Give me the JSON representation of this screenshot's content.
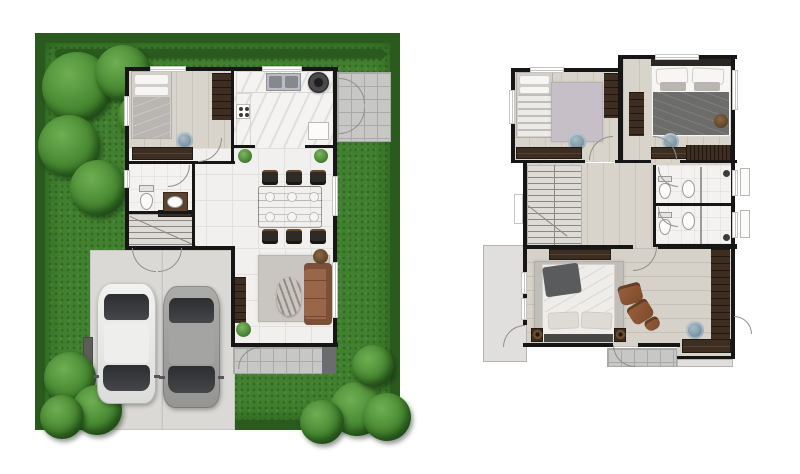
{
  "image": {
    "kind": "architectural-floor-plan-rendering",
    "panels": 2,
    "visible_text": ""
  },
  "plans": [
    {
      "id": "first-floor-site-plan",
      "site_elements": [
        "lawn",
        "hedge-border",
        "trees-shrubs",
        "concrete-driveway",
        "ac-pad"
      ],
      "rooms": [
        "bedroom",
        "bathroom",
        "stairs",
        "kitchen",
        "dining-area",
        "living-room",
        "rear-terrace",
        "front-terrace",
        "carport"
      ],
      "furniture": [
        "single-bed",
        "wardrobe",
        "dresser",
        "pouf",
        "toilet",
        "vanity-sink",
        "kitchen-counter",
        "double-sink",
        "round-cooktop",
        "cooktop",
        "refrigerator",
        "dining-table",
        "dining-chair-x6",
        "plate-x6",
        "sofa",
        "coffee-table",
        "tv-cabinet",
        "side-table",
        "potted-plant-x3",
        "white-car",
        "gray-car"
      ]
    },
    {
      "id": "second-floor-plan",
      "rooms": [
        "bedroom-2",
        "master-bedroom",
        "bedroom-3",
        "bathroom-upper",
        "bathroom-lower",
        "hallway",
        "stairs",
        "balcony-left",
        "balcony-rear",
        "walk-in-closet"
      ],
      "furniture": [
        "single-bed",
        "double-bed-x2",
        "rug-x3",
        "wardrobe-x4",
        "dresser-x4",
        "pouf-x3",
        "nightstand-x2",
        "lamp-x2",
        "armchair-x2",
        "ottoman",
        "toilet-x2",
        "pedestal-sink-x2",
        "shower-x2",
        "tv-cabinet",
        "round-side-table",
        "ac-unit-x2"
      ]
    }
  ],
  "colors": {
    "wall": "#161616",
    "grass-base": "#41802e",
    "hedge": "#2a5a1e",
    "bush-light": "#6fae52",
    "bush-mid": "#468730",
    "bush-dark": "#27541c",
    "wood-floor": "#d9d4cb",
    "wood-floor2": "#d6d1c9",
    "tile-floor": "#f1f0ee",
    "tile-line": "#e1e0dd",
    "marble": "#f4f3f1",
    "bath-floor": "#f3f2f0",
    "terrace-tile": "#c7c7c5",
    "terrace-line": "#a9a9a7",
    "terrace-dark": "#6a6c6e",
    "concrete": "#dbd9d5",
    "concrete-line": "#c8c6c2",
    "balcony": "#e0dfdd",
    "balcony-line": "#b5b4b2",
    "dark-wood": "#3e2e21",
    "mid-wood": "#5a4430",
    "chair-dark": "#2e2a26",
    "chair-wood": "#6b4a2c",
    "sofa": "#996649",
    "sofa-dark": "#7c4f38",
    "rug": "#c9c6c1",
    "rug-lilac": "#c6bfc7",
    "rug-warm": "#c1bdb8",
    "bed-frame": "#d3cfca",
    "bed-gray": "#b9b5b0",
    "duvet-dark": "#6c6c6a",
    "linen-white": "#f7f6f4",
    "linen-warm": "#efede9",
    "pouf": "#7d96a6",
    "pouf-dark": "#56707f",
    "steel": "#b9bcc0",
    "appliance-dark": "#3b3b3d",
    "plant-green": "#4e8a3a",
    "plant-dark": "#2e5c1e",
    "glass-dark": "#2c2e32",
    "fixture-line": "#9a9a98",
    "door-arc": "#8f8f8d",
    "win-frame": "#c6c5c3",
    "stair-bg": "#dedbd6",
    "stair-line": "#8a8884",
    "ac-pad": "#5c5c5a",
    "throw-dark": "#595b5d",
    "bench-dark": "#474745",
    "headboard-dark": "#2b2723"
  }
}
